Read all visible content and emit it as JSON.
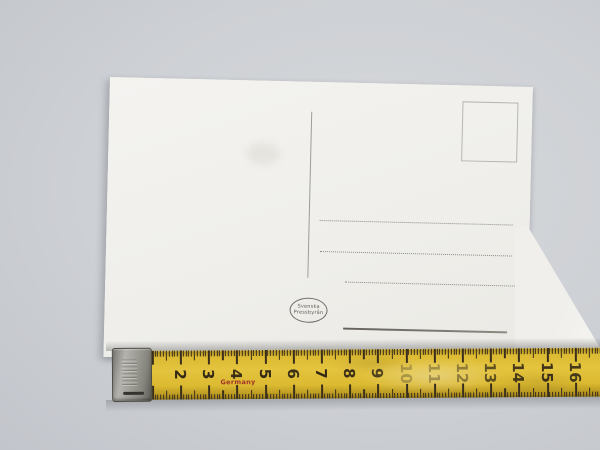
{
  "postcard": {
    "publisher_mark": {
      "line1": "Svenska",
      "line2": "Pressbyrån"
    }
  },
  "tape": {
    "origin_label": "Germany",
    "unit_numbers": [
      {
        "value": 2,
        "wear_opacity": 0.95
      },
      {
        "value": 3,
        "wear_opacity": 0.95
      },
      {
        "value": 4,
        "wear_opacity": 0.9
      },
      {
        "value": 5,
        "wear_opacity": 0.95
      },
      {
        "value": 6,
        "wear_opacity": 0.9
      },
      {
        "value": 7,
        "wear_opacity": 0.95
      },
      {
        "value": 8,
        "wear_opacity": 0.9
      },
      {
        "value": 9,
        "wear_opacity": 0.8
      },
      {
        "value": 10,
        "wear_opacity": 0.3
      },
      {
        "value": 11,
        "wear_opacity": 0.35
      },
      {
        "value": 12,
        "wear_opacity": 0.45
      },
      {
        "value": 13,
        "wear_opacity": 0.7
      },
      {
        "value": 14,
        "wear_opacity": 0.85
      },
      {
        "value": 15,
        "wear_opacity": 0.9
      },
      {
        "value": 16,
        "wear_opacity": 0.85
      }
    ],
    "colors": {
      "tape_yellow": "#ddb932",
      "tick": "#3a2f1d",
      "number": "#2a2114",
      "origin_label_red": "#a23427"
    }
  }
}
